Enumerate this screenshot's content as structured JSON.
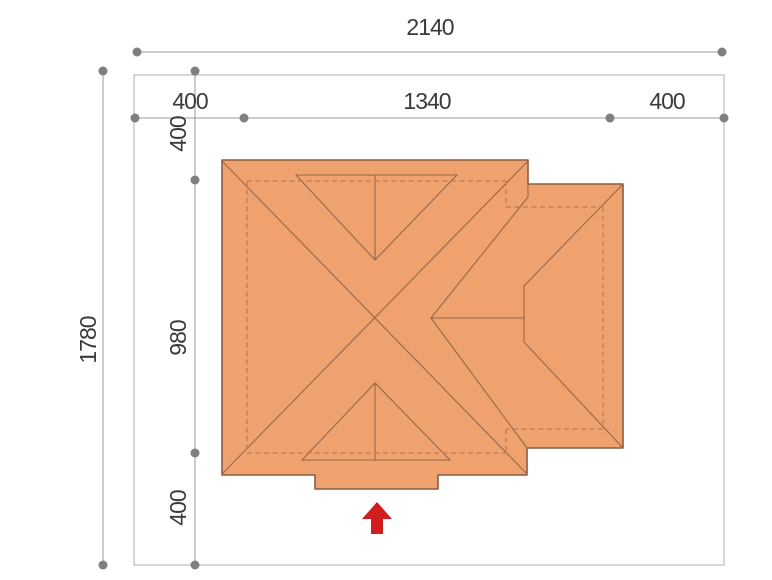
{
  "site_plan": {
    "dimensions": {
      "horizontal": {
        "total": "2140",
        "left_setback": "400",
        "building": "1340",
        "right_setback": "400"
      },
      "vertical": {
        "total": "1780",
        "top_setback": "400",
        "building": "980",
        "bottom_setback": "400"
      }
    },
    "colors": {
      "roof_fill": "#efa26d",
      "roof_edge": "#8a5c3e",
      "roof_line": "#96684a",
      "wall_dashed": "#c57a4d",
      "dimension_gray": "#9b9b9b",
      "dot_gray": "#7f7f7f",
      "boundary_gray": "#bcbcbc",
      "text_color": "#3a3a3a",
      "arrow_red": "#d01e1e"
    },
    "icons": {
      "entrance_arrow": "up-arrow"
    }
  }
}
